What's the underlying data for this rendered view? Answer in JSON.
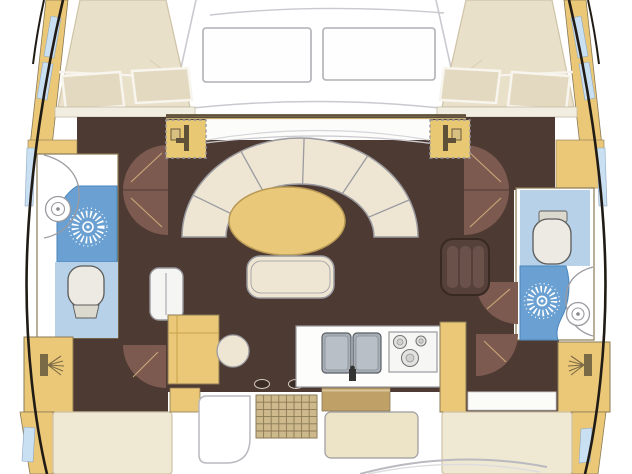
{
  "floorplan": {
    "type": "catamaran accommodation plan, top view, bow up",
    "hulls": {
      "port": [
        "bow-double-berth-with-pillows",
        "bathroom-shower-toilet-round-sink",
        "wardrobe-vanity",
        "aft-double-berth"
      ],
      "starboard": [
        "bow-double-berth-with-pillows",
        "bathroom-toilet-shower-round-sink",
        "wardrobe-vanity",
        "aft-double-berth"
      ]
    },
    "bridgedeck": [
      "foredeck-with-two-hatches",
      "u-shaped-settee-six-segments",
      "oval-saloon-table",
      "bench-seat",
      "port-folding-chair",
      "starboard-slatted-chair",
      "nav-cabinet",
      "round-stool",
      "galley-double-sink-with-tap",
      "galley-three-burner-stove",
      "cockpit-grating",
      "aft-cockpit-cushion",
      "companionway-steps"
    ],
    "counts": {
      "cabins": 4,
      "bathrooms": 2,
      "deck_hatches": 2,
      "settee_segments": 6,
      "stove_burners": 3,
      "door_swings": 6
    }
  },
  "colors": {
    "background": "#ffffff",
    "hull_outline": "#211b15",
    "deck_line": "#b9b9bf",
    "cabinetry": "#eac878",
    "cabinetry_edge": "#8a7a55",
    "floor": "#4d3a32",
    "door": "#7d5a50",
    "door_trim": "#caa878",
    "berth": "#e9e0ca",
    "berth_aft": "#efe8d2",
    "pillow": "#e3d9c0",
    "upholstery": "#eee6d3",
    "table": "#eac87a",
    "shower": "#6aa0d2",
    "shower_edge": "#4a86bc",
    "wet_room": "#b7d2e8",
    "window": "#c9dff2",
    "fixture": "#eceae2",
    "steel": "#a7adb4",
    "grating": "#cdb98c",
    "step_block": "#bfa066",
    "cushion": "#ede3c6",
    "outline": "#9a9aa0"
  },
  "icons": {
    "shower_head": "white radial starburst on blue shower floor",
    "toilet": "rounded bowl with small tank",
    "round_sink": "concentric circles",
    "galley_sink": "double steel basin with tap",
    "stove": "three burner rings",
    "door_swing": "quarter-circle brown arc",
    "deck_fitting": "dark glyph in dashed yellow square",
    "vanity_basin": "bar with spray lines",
    "grating": "tan waffle grid",
    "hull_window": "light blue strip"
  }
}
